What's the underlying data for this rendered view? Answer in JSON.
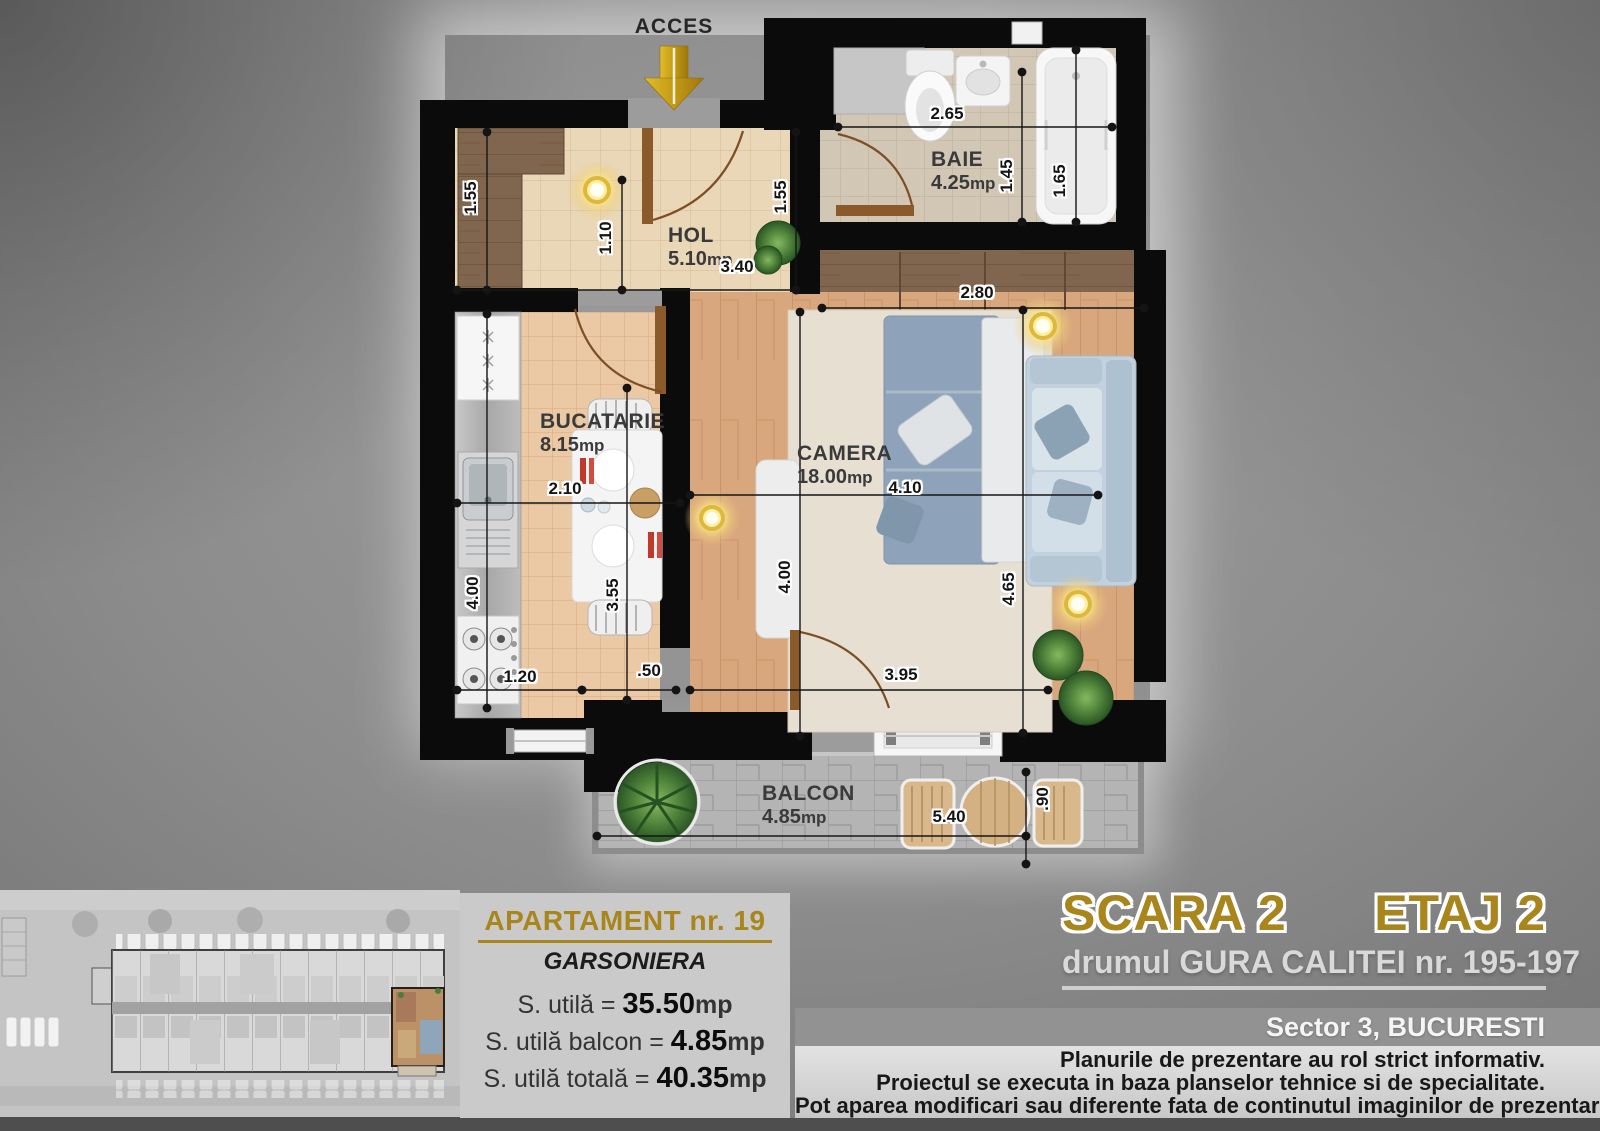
{
  "plan": {
    "access_label": "ACCES",
    "rooms": [
      {
        "name": "HOL",
        "area": "5.10",
        "unit": "mp"
      },
      {
        "name": "BAIE",
        "area": "4.25",
        "unit": "mp"
      },
      {
        "name": "BUCATARIE",
        "area": "8.15",
        "unit": "mp"
      },
      {
        "name": "CAMERA",
        "area": "18.00",
        "unit": "mp"
      },
      {
        "name": "BALCON",
        "area": "4.85",
        "unit": "mp"
      }
    ],
    "dimensions": [
      "1.55",
      "1.10",
      "3.40",
      "1.55",
      "2.65",
      "1.45",
      "1.65",
      "2.80",
      "2.10",
      "4.00",
      "3.55",
      "4.00",
      "4.10",
      "4.65",
      "1.20",
      ".50",
      "3.95",
      "5.40",
      ".90"
    ]
  },
  "info_panel": {
    "title": "APARTAMENT nr. 19",
    "subtitle": "GARSONIERA",
    "rows": [
      {
        "label": "S. utilă = ",
        "value": "35.50",
        "unit": "mp"
      },
      {
        "label": "S. utilă balcon = ",
        "value": "4.85",
        "unit": "mp"
      },
      {
        "label": "S. utilă totală = ",
        "value": "40.35",
        "unit": "mp"
      },
      {
        "label": "S. constr. totală = ",
        "value": "50.10",
        "unit": "mp"
      }
    ]
  },
  "location": {
    "scara": "SCARA 2",
    "etaj": "ETAJ 2",
    "address": "drumul GURA CALITEI nr. 195-197",
    "sector": "Sector 3, BUCURESTI"
  },
  "disclaimer": {
    "line1": "Planurile de prezentare au rol strict informativ.",
    "line2": "Proiectul se executa in baza planselor tehnice si de specialitate.",
    "line3": "Pot aparea modificari sau diferente fata de continutul imaginilor de prezentare."
  },
  "colors": {
    "gold": "#a8861b",
    "arrow": "#c9a227"
  }
}
